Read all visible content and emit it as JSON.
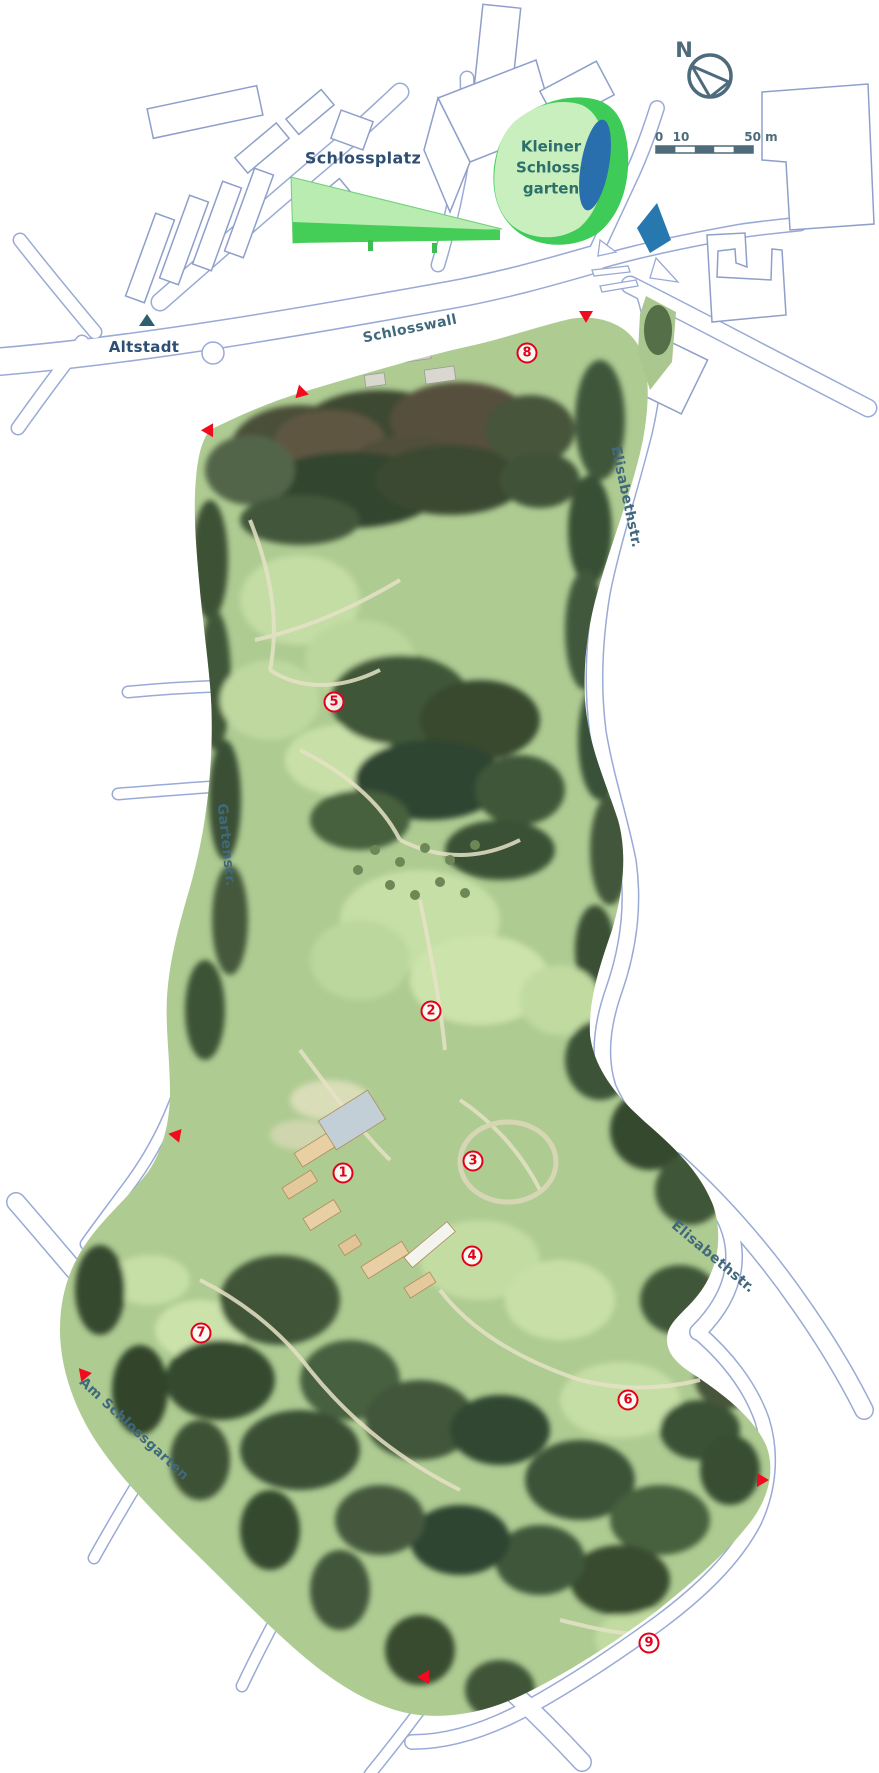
{
  "labels": {
    "schlossplatz": "Schlossplatz",
    "kleiner_schlossgarten_line1": "Kleiner",
    "kleiner_schlossgarten_line2": "Schloss-",
    "kleiner_schlossgarten_line3": "garten",
    "altstadt": "Altstadt",
    "schlosswall": "Schlosswall",
    "elisabethstr": "Elisabethstr.",
    "gartenstr": "Gartenstr.",
    "am_schlossgarten": "Am Schlossgarten",
    "north_indicator": "N"
  },
  "scale_bar": {
    "start_label": "0",
    "mid_label": "10",
    "end_label": "50 m",
    "segments": 5,
    "total_meters": 50
  },
  "markers": [
    {
      "number": "1",
      "x": 343,
      "y": 1173
    },
    {
      "number": "2",
      "x": 431,
      "y": 1011
    },
    {
      "number": "3",
      "x": 473,
      "y": 1161
    },
    {
      "number": "4",
      "x": 472,
      "y": 1256
    },
    {
      "number": "5",
      "x": 334,
      "y": 702
    },
    {
      "number": "6",
      "x": 628,
      "y": 1400
    },
    {
      "number": "7",
      "x": 201,
      "y": 1333
    },
    {
      "number": "8",
      "x": 527,
      "y": 353
    },
    {
      "number": "9",
      "x": 649,
      "y": 1643
    }
  ],
  "entrances": [
    {
      "x": 303,
      "y": 393,
      "angle": -75
    },
    {
      "x": 210,
      "y": 432,
      "angle": -30
    },
    {
      "x": 586,
      "y": 317,
      "angle": 0
    },
    {
      "x": 177,
      "y": 1137,
      "angle": -20
    },
    {
      "x": 86,
      "y": 1374,
      "angle": -100
    },
    {
      "x": 763,
      "y": 1480,
      "angle": -90
    },
    {
      "x": 423,
      "y": 1677,
      "angle": 90
    }
  ],
  "colors": {
    "marker_red": "#e3001a",
    "entrance_red": "#f20b1e",
    "street_label": "#40697c",
    "city_label": "#2e4f74",
    "garden_label": "#2c6f6b",
    "compass": "#4d6b7a",
    "water_blue": "#2a6fad",
    "bright_green": "#3ecb58",
    "light_green": "#c9efbe"
  }
}
